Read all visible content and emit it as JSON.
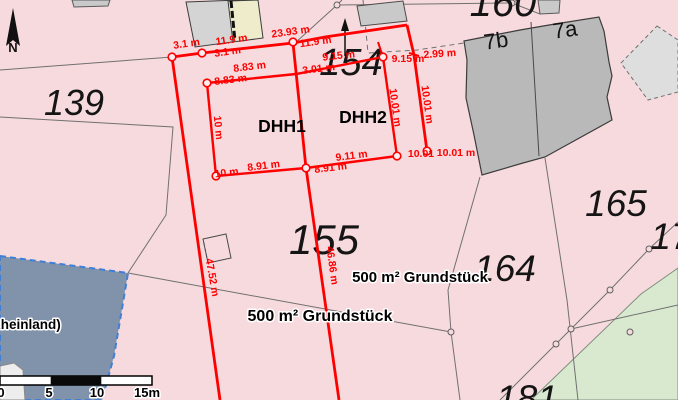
{
  "colors": {
    "background_pink": "#f7dadd",
    "measurement_red": "#ff0000",
    "selected_parcel_blue": "#8093ab",
    "selection_border_blue": "#3f7fd6",
    "green_area": "#d9e9d0",
    "building_gray": "#b9b9b9"
  },
  "north": {
    "label": "N"
  },
  "parcels": {
    "p139": "139",
    "p154": "154",
    "p155": "155",
    "p160": "160",
    "p164": "164",
    "p165": "165",
    "p17": "17",
    "p181": "181",
    "b7b": "7b",
    "b7a": "7a"
  },
  "plots": {
    "dhh1": "DHH1",
    "dhh2": "DHH2"
  },
  "annotations": {
    "area1": "500 m² Grundstück",
    "area2": "500 m² Grundstück",
    "place": "chlingen (Rheinland)"
  },
  "dimensions": {
    "d31a": "3.1 m",
    "d31b": "3.1 m",
    "d119a": "11.9 m",
    "d119b": "11.9 m",
    "d2393": "23.93 m",
    "d915a": "9.15 m",
    "d915b": "9.15 m",
    "d299": "2.99 m",
    "d883a": "8.83 m",
    "d883b": "8.83 m",
    "d301": "3.01 m",
    "d10": "10 m",
    "d10b": "10 m",
    "d1001a": "10.01 m",
    "d1001b": "10.01 m",
    "d1001c": "10.01",
    "d1001d": "10.01 m",
    "d891a": "8.91 m",
    "d891b": "8.91 m",
    "d911": "9.11 m",
    "d4752": "47.52 m",
    "d4686": "46.86 m"
  },
  "scalebar": {
    "t0": "0",
    "t5": "5",
    "t10": "10",
    "t15": "15m"
  }
}
